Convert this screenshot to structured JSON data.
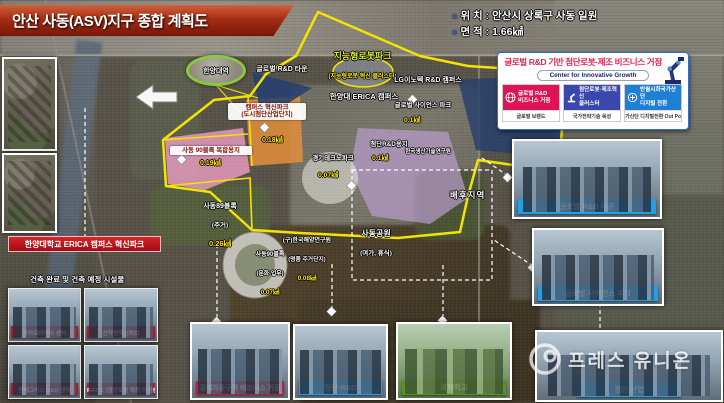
{
  "banner": {
    "title": "안산 사동(ASV)지구 종합 계획도"
  },
  "info": {
    "items": [
      {
        "label": "위 치 :",
        "value": "안산시 상록구 사동 일원"
      },
      {
        "label": "면 적 :",
        "value": "1.66㎢"
      }
    ]
  },
  "panel": {
    "title": "글로벌 R&D 기반 첨단로봇·제조 비즈니스 거점",
    "subtitle": "Center for Innovative Growth",
    "cards": [
      {
        "line1": "글로벌 R&D",
        "line2": "비즈니스 거점",
        "footer": "글로벌 브랜드",
        "color": "#dd1458",
        "icon": "globe-icon"
      },
      {
        "line1": "첨단로봇·제조혁신",
        "line2": "클러스터",
        "footer": "국가전략기술 육성",
        "color": "#3a47ad",
        "icon": "robot-arm-icon"
      },
      {
        "line1": "반월시화국가산단",
        "line2": "디지털 전환",
        "footer": "국가산단 디지털전환 Out Post",
        "color": "#1f7fd4",
        "icon": "digital-icon"
      }
    ]
  },
  "map": {
    "station": "한양대역",
    "zones": [
      {
        "line1": "지능형로봇파크",
        "line2": "(지능형로봇 혁신 클러스터)"
      },
      {
        "line1": "글로벌 R&D 타운"
      },
      {
        "line1": "LG이노텍 R&D 캠퍼스"
      },
      {
        "line1": "한양대 ERICA 캠퍼스"
      },
      {
        "line1": "캠퍼스 혁신파크",
        "line2": "(도시첨단산업단지)",
        "value": "0.18㎢"
      },
      {
        "line1": "사동 90블록 복합용지",
        "value": "0.19㎢"
      },
      {
        "line1": "사동89블록",
        "line2": "(주거)",
        "value": "0.26㎢"
      },
      {
        "line1": "경기테크노파크",
        "value": "0.07㎢"
      },
      {
        "line1": "첨단R&D용지",
        "value": "0.1㎢"
      },
      {
        "line1": "글로벌 사이언스 파크",
        "value": "0.1㎢"
      },
      {
        "line1": "한국생산기술연구원"
      },
      {
        "line1": "배후지역"
      },
      {
        "line1": "사동공원",
        "line2": "(여가, 휴식)"
      },
      {
        "line1": "(구)한국해양연구원",
        "line2": "(명품 주거단지)",
        "value": "0.08㎢"
      },
      {
        "line1": "사동90블록",
        "line2": "(문화·업무)",
        "value": "0.07㎢"
      }
    ]
  },
  "left": {
    "banner": "한양대학교 ERICA 캠퍼스 혁신파크",
    "subtitle": "건축 완료 및 건축 예정 시설물",
    "facilities": [
      {
        "label": "카카오데이터 센터"
      },
      {
        "label": "산학연혁신허브"
      },
      {
        "label": "엔테그리스 R&D 센터"
      },
      {
        "label": "RATIC (첨단로봇 특화 지원센터)"
      }
    ]
  },
  "photos": {
    "bottom": [
      {
        "label": "경제자유구역 비즈니스 거점",
        "color": "#c01f3c"
      },
      {
        "label": "첨단 R&D",
        "color": "#21a0e8"
      },
      {
        "label": "국제학교",
        "color": "#5a8f29"
      }
    ],
    "right": [
      {
        "label": "글로벌 R&D 타운",
        "color": "#21a0e8"
      },
      {
        "label": "글로벌 사이언스 파크",
        "color": "#21a0e8"
      },
      {
        "label": "첨단 산업",
        "color": "#21a0e8"
      }
    ]
  },
  "watermark": {
    "text": "프레스 유니온"
  },
  "colors": {
    "accent_red": "#c01f3c",
    "accent_blue": "#21a0e8",
    "accent_green": "#5a8f29",
    "boundary": "#f2e400"
  }
}
